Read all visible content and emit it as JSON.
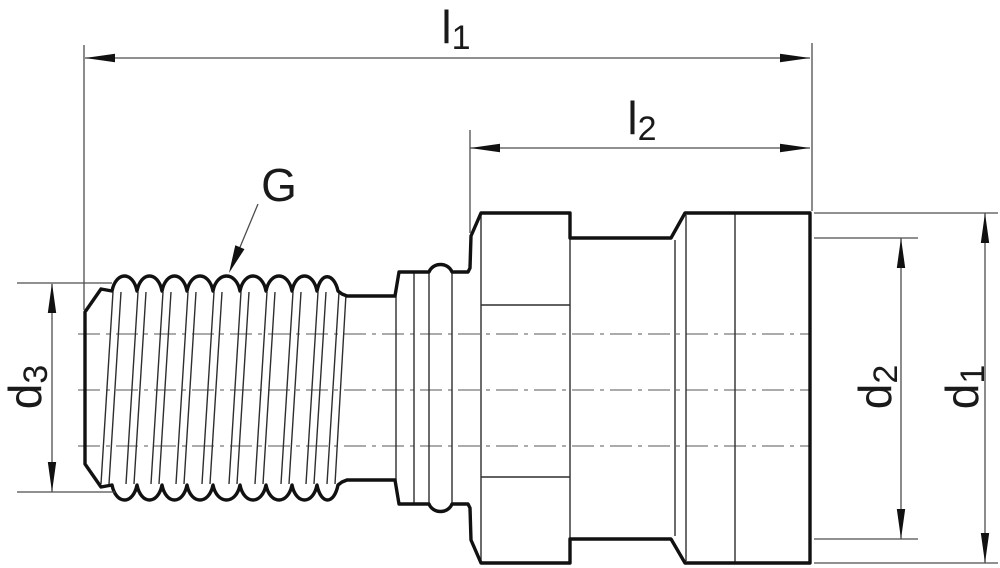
{
  "drawing": {
    "type": "technical-dimension-drawing",
    "subject": "threaded-plug-fitting-side-view",
    "labels": {
      "l1": {
        "base": "l",
        "sub": "1"
      },
      "l2": {
        "base": "l",
        "sub": "2"
      },
      "G": {
        "base": "G",
        "sub": ""
      },
      "d1": {
        "base": "d",
        "sub": "1"
      },
      "d2": {
        "base": "d",
        "sub": "2"
      },
      "d3": {
        "base": "d",
        "sub": "3"
      }
    },
    "colors": {
      "background": "#ffffff",
      "outline": "#111111",
      "thin_line": "#2e2e2e",
      "dimension_line": "#4d4d4d",
      "centerline": "#8f8f8f",
      "text": "#1a1a1a"
    }
  }
}
